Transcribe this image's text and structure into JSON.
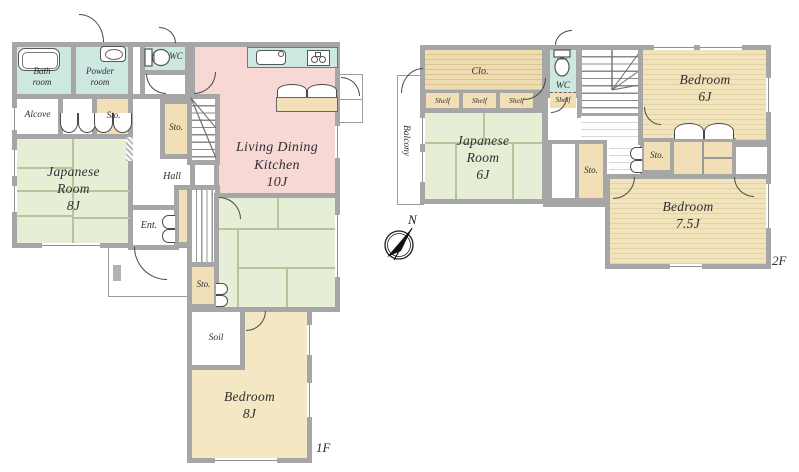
{
  "floor1": {
    "floor_label": "1F",
    "rooms": {
      "bath_l1": "Bath",
      "bath_l2": "room",
      "powder_l1": "Powder",
      "powder_l2": "room",
      "wc": "WC",
      "alcove": "Alcove",
      "sto": "Sto.",
      "japanese_l1": "Japanese",
      "japanese_l2": "Room",
      "japanese_l3": "8J",
      "hall": "Hall",
      "ldk_l1": "Living Dining",
      "ldk_l2": "Kitchen",
      "ldk_l3": "10J",
      "ent": "Ent.",
      "soil": "Soil",
      "bedroom_l1": "Bedroom",
      "bedroom_l2": "8J"
    }
  },
  "floor2": {
    "floor_label": "2F",
    "rooms": {
      "clo": "Clo.",
      "shelf": "Shelf",
      "wc": "WC",
      "japanese_l1": "Japanese",
      "japanese_l2": "Room",
      "japanese_l3": "6J",
      "balcony": "Balcony",
      "sto": "Sto.",
      "bedroom6_l1": "Bedroom",
      "bedroom6_l2": "6J",
      "bedroom75_l1": "Bedroom",
      "bedroom75_l2": "7.5J"
    }
  },
  "compass": {
    "north": "N"
  },
  "colors": {
    "wall": "#a6a6a6",
    "wet_area": "#cde7e1",
    "ldk": "#f8d8d4",
    "tatami": "#e6efd6",
    "storage": "#f1dfb8",
    "flooring": "#f0e2bd"
  }
}
